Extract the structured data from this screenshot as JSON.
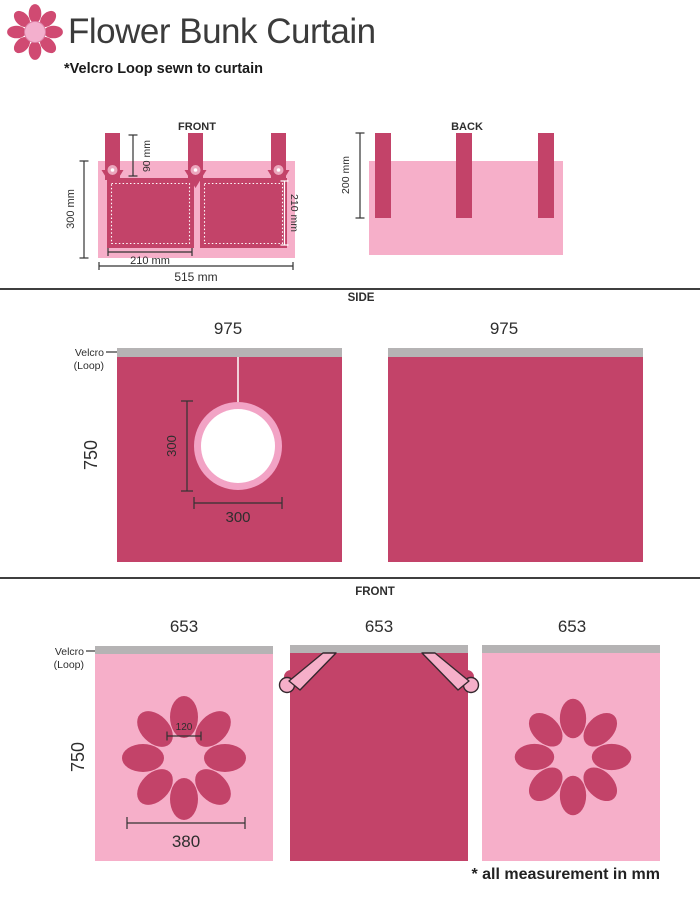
{
  "header": {
    "title": "Flower Bunk Curtain",
    "subtitle": "*Velcro Loop sewn to curtain"
  },
  "colors": {
    "dark_pink": "#C34369",
    "light_pink": "#F6AFC9",
    "hole_ring_pink": "#F2A3C5",
    "velcro_gray": "#B5B3B4",
    "logo_pink": "#D04A72",
    "text_dark": "#333333"
  },
  "pocket_front": {
    "label": "FRONT",
    "strap_height": "90 mm",
    "total_height": "300 mm",
    "pocket_width": "210 mm",
    "pocket_height": "210 mm",
    "total_width": "515 mm"
  },
  "pocket_back": {
    "label": "BACK",
    "strap_length": "200 mm"
  },
  "side": {
    "title": "SIDE",
    "velcro_line1": "Velcro",
    "velcro_line2": "(Loop)",
    "panel1_width": "975",
    "panel2_width": "975",
    "height": "750",
    "hole_height": "300",
    "hole_width": "300"
  },
  "front": {
    "title": "FRONT",
    "velcro_line1": "Velcro",
    "velcro_line2": "(Loop)",
    "panel_widths": [
      "653",
      "653",
      "653"
    ],
    "height": "750",
    "flower_center_width": "120",
    "flower_width": "380"
  },
  "footer": {
    "note": "* all measurement in mm"
  }
}
